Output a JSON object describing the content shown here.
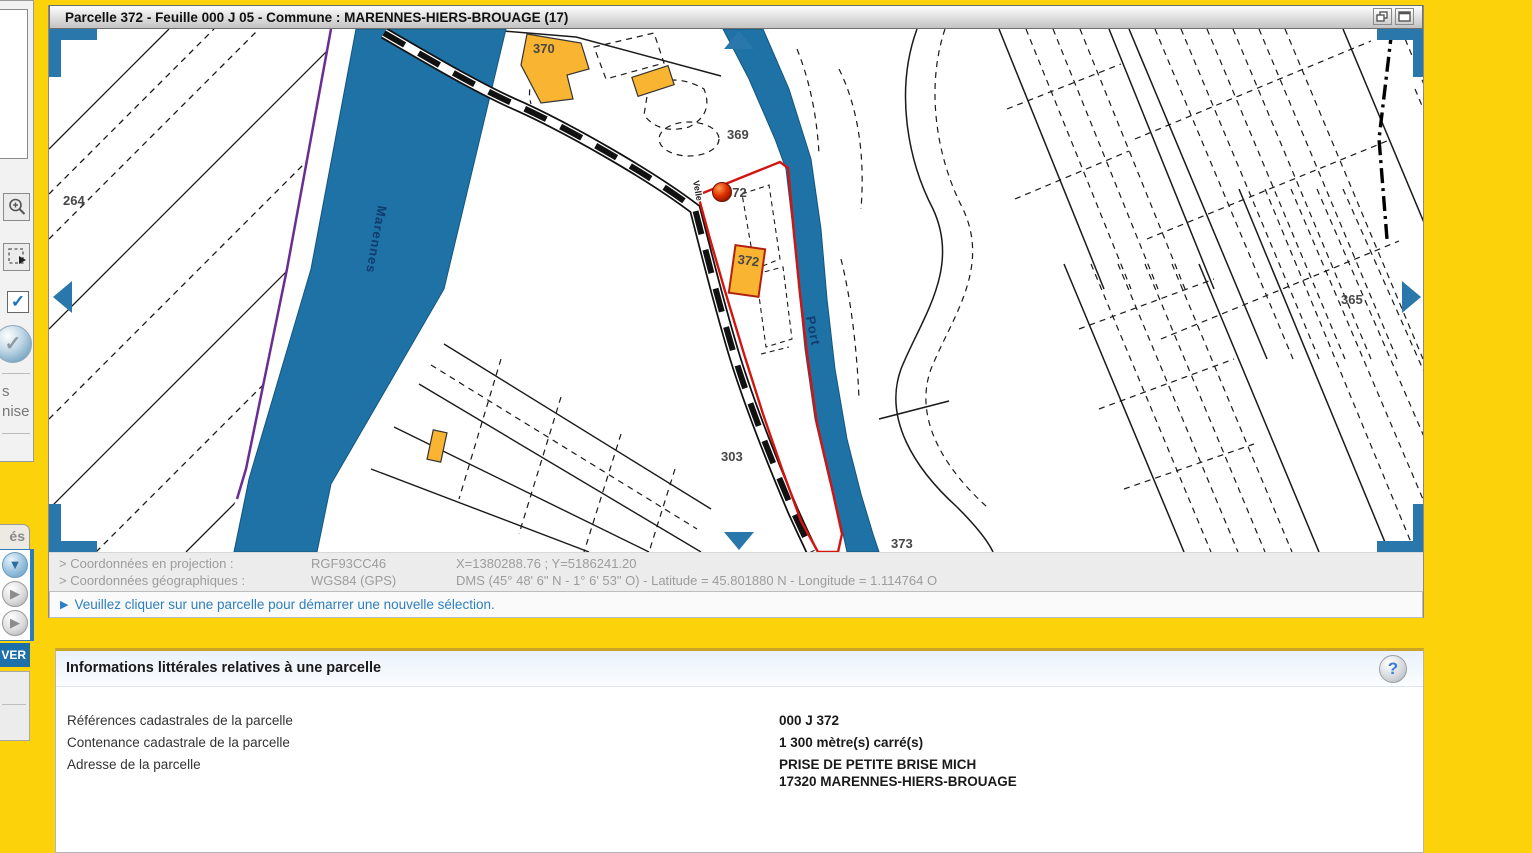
{
  "window": {
    "title": "Parcelle 372 - Feuille 000 J 05 - Commune : MARENNES-HIERS-BROUAGE (17)"
  },
  "map": {
    "labels": {
      "p264": "264",
      "p370": "370",
      "p369": "369",
      "p372_marker": "372",
      "p372_building": "372",
      "p303": "303",
      "p373": "373",
      "p365": "365"
    },
    "streets": {
      "river": "Marennes",
      "channel": "Port",
      "road": "Velle"
    }
  },
  "coords": {
    "row1": {
      "label": "> Coordonnées en projection :",
      "system": "RGF93CC46",
      "value": "X=1380288.76 ; Y=5186241.20"
    },
    "row2": {
      "label": "> Coordonnées géographiques :",
      "system": "WGS84 (GPS)",
      "value": "DMS (45° 48' 6\" N - 1° 6' 53\" O) - Latitude = 45.801880 N - Longitude = 1.114764 O"
    }
  },
  "message": {
    "text": "Veuillez cliquer sur une parcelle pour démarrer une nouvelle sélection."
  },
  "info": {
    "title": "Informations littérales relatives à une parcelle",
    "help": "?",
    "rows": [
      {
        "label": "Références cadastrales de la parcelle",
        "value": "000 J 372"
      },
      {
        "label": "Contenance cadastrale de la parcelle",
        "value": "1 300 mètre(s) carré(s)"
      },
      {
        "label": "Adresse de la parcelle",
        "value": "PRISE DE PETITE BRISE MICH",
        "value2": "17320 MARENNES-HIERS-BROUAGE"
      }
    ]
  },
  "sidebar": {
    "check_glyph": "✓",
    "validate_glyph": "✓",
    "text_line1": "s",
    "text_line2": "nise",
    "tab_label": "és",
    "send_label": "VER",
    "orb_down_glyph": "▼",
    "orb_play_glyph": "▶"
  },
  "colors": {
    "page_yellow": "#fcd20a",
    "water_blue": "#1f72a6",
    "nav_blue": "#2a77ac",
    "selection_red": "#d21510",
    "building_orange": "#f9b432",
    "link_blue": "#2d7fc1"
  }
}
